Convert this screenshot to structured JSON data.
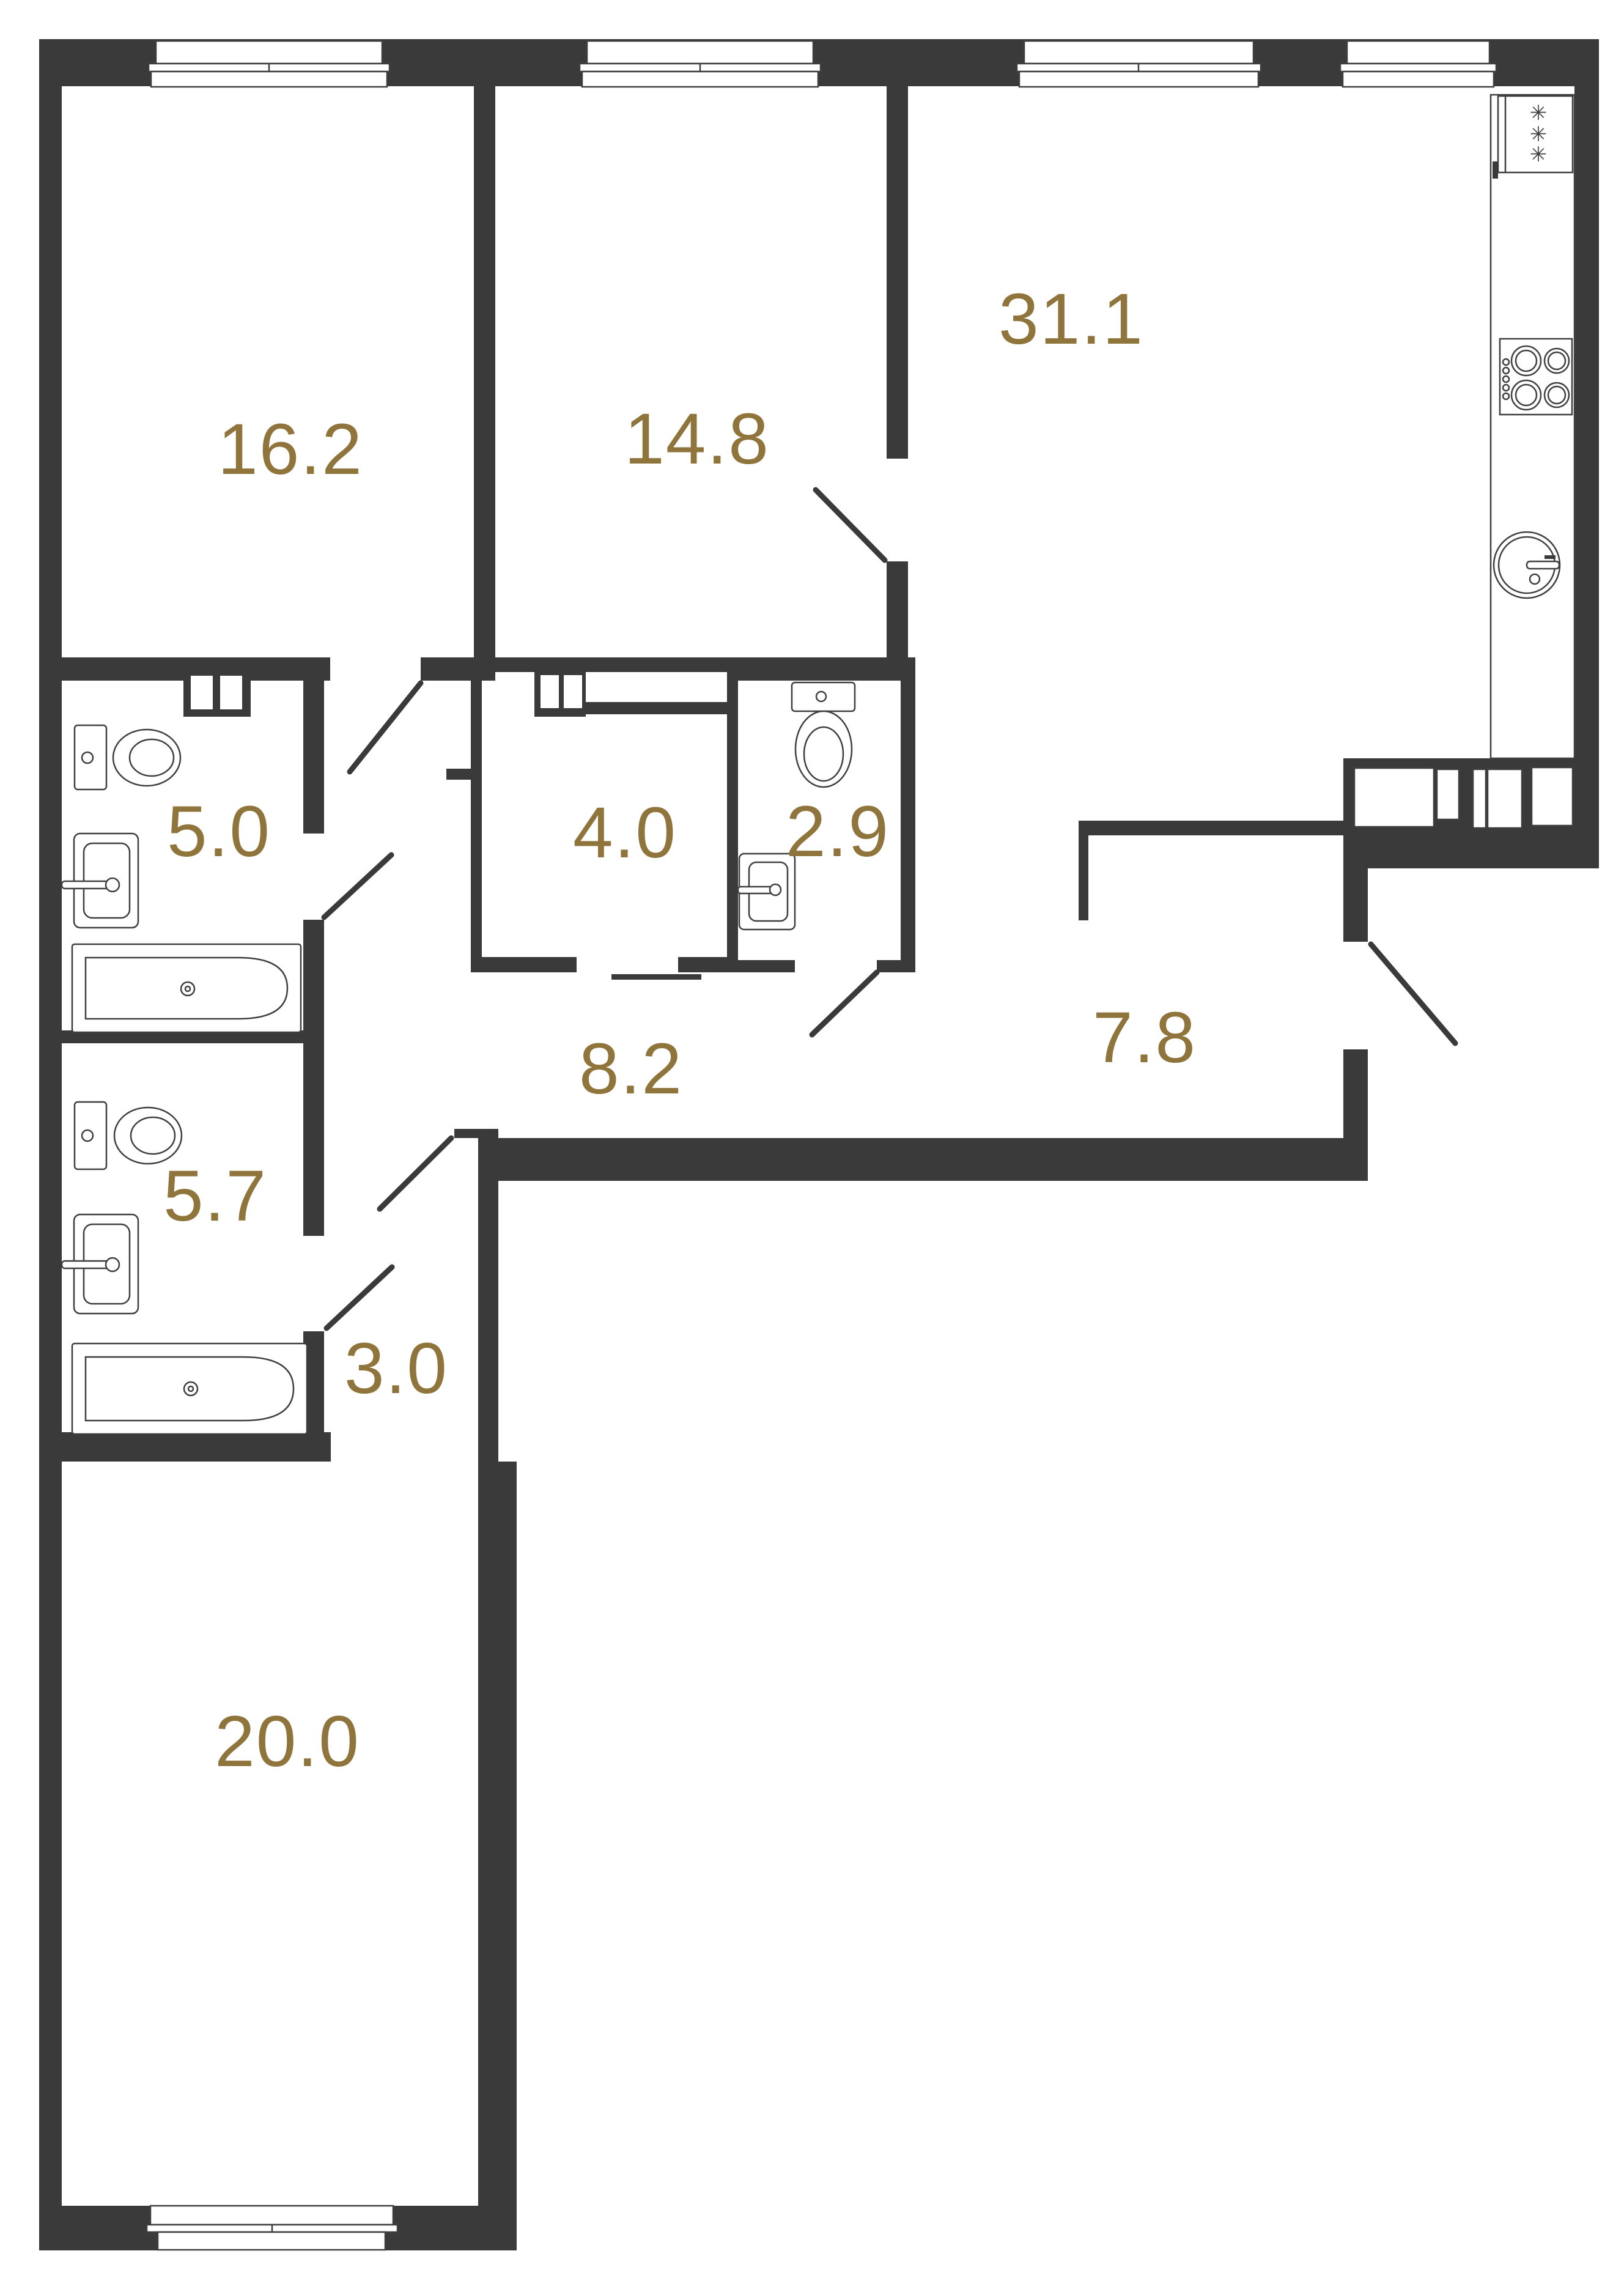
{
  "plan": {
    "type": "apartment-floor-plan",
    "colors": {
      "wall": "#3a3a3a",
      "fixture_line": "#3f3f3f",
      "label": "#8f743b",
      "background": "#ffffff"
    },
    "rooms": [
      {
        "name": "room-top-left",
        "area": "16.2"
      },
      {
        "name": "room-top-middle",
        "area": "14.8"
      },
      {
        "name": "kitchen-living",
        "area": "31.1"
      },
      {
        "name": "bathroom-upper",
        "area": "5.0"
      },
      {
        "name": "storage-room",
        "area": "4.0"
      },
      {
        "name": "wc",
        "area": "2.9"
      },
      {
        "name": "hallway",
        "area": "8.2"
      },
      {
        "name": "entry-hall",
        "area": "7.8"
      },
      {
        "name": "bathroom-lower",
        "area": "5.7"
      },
      {
        "name": "corridor",
        "area": "3.0"
      },
      {
        "name": "room-bottom",
        "area": "20.0"
      }
    ],
    "fixtures": [
      "toilet-icon",
      "washbasin-icon",
      "bathtub-icon",
      "fridge-icon",
      "stove-icon",
      "kitchen-sink-icon",
      "vent-shaft-icon",
      "door-swing",
      "window",
      "kitchen-counter",
      "appliance-row"
    ],
    "fridge_snowflakes": "✳ ✳ ✳"
  }
}
